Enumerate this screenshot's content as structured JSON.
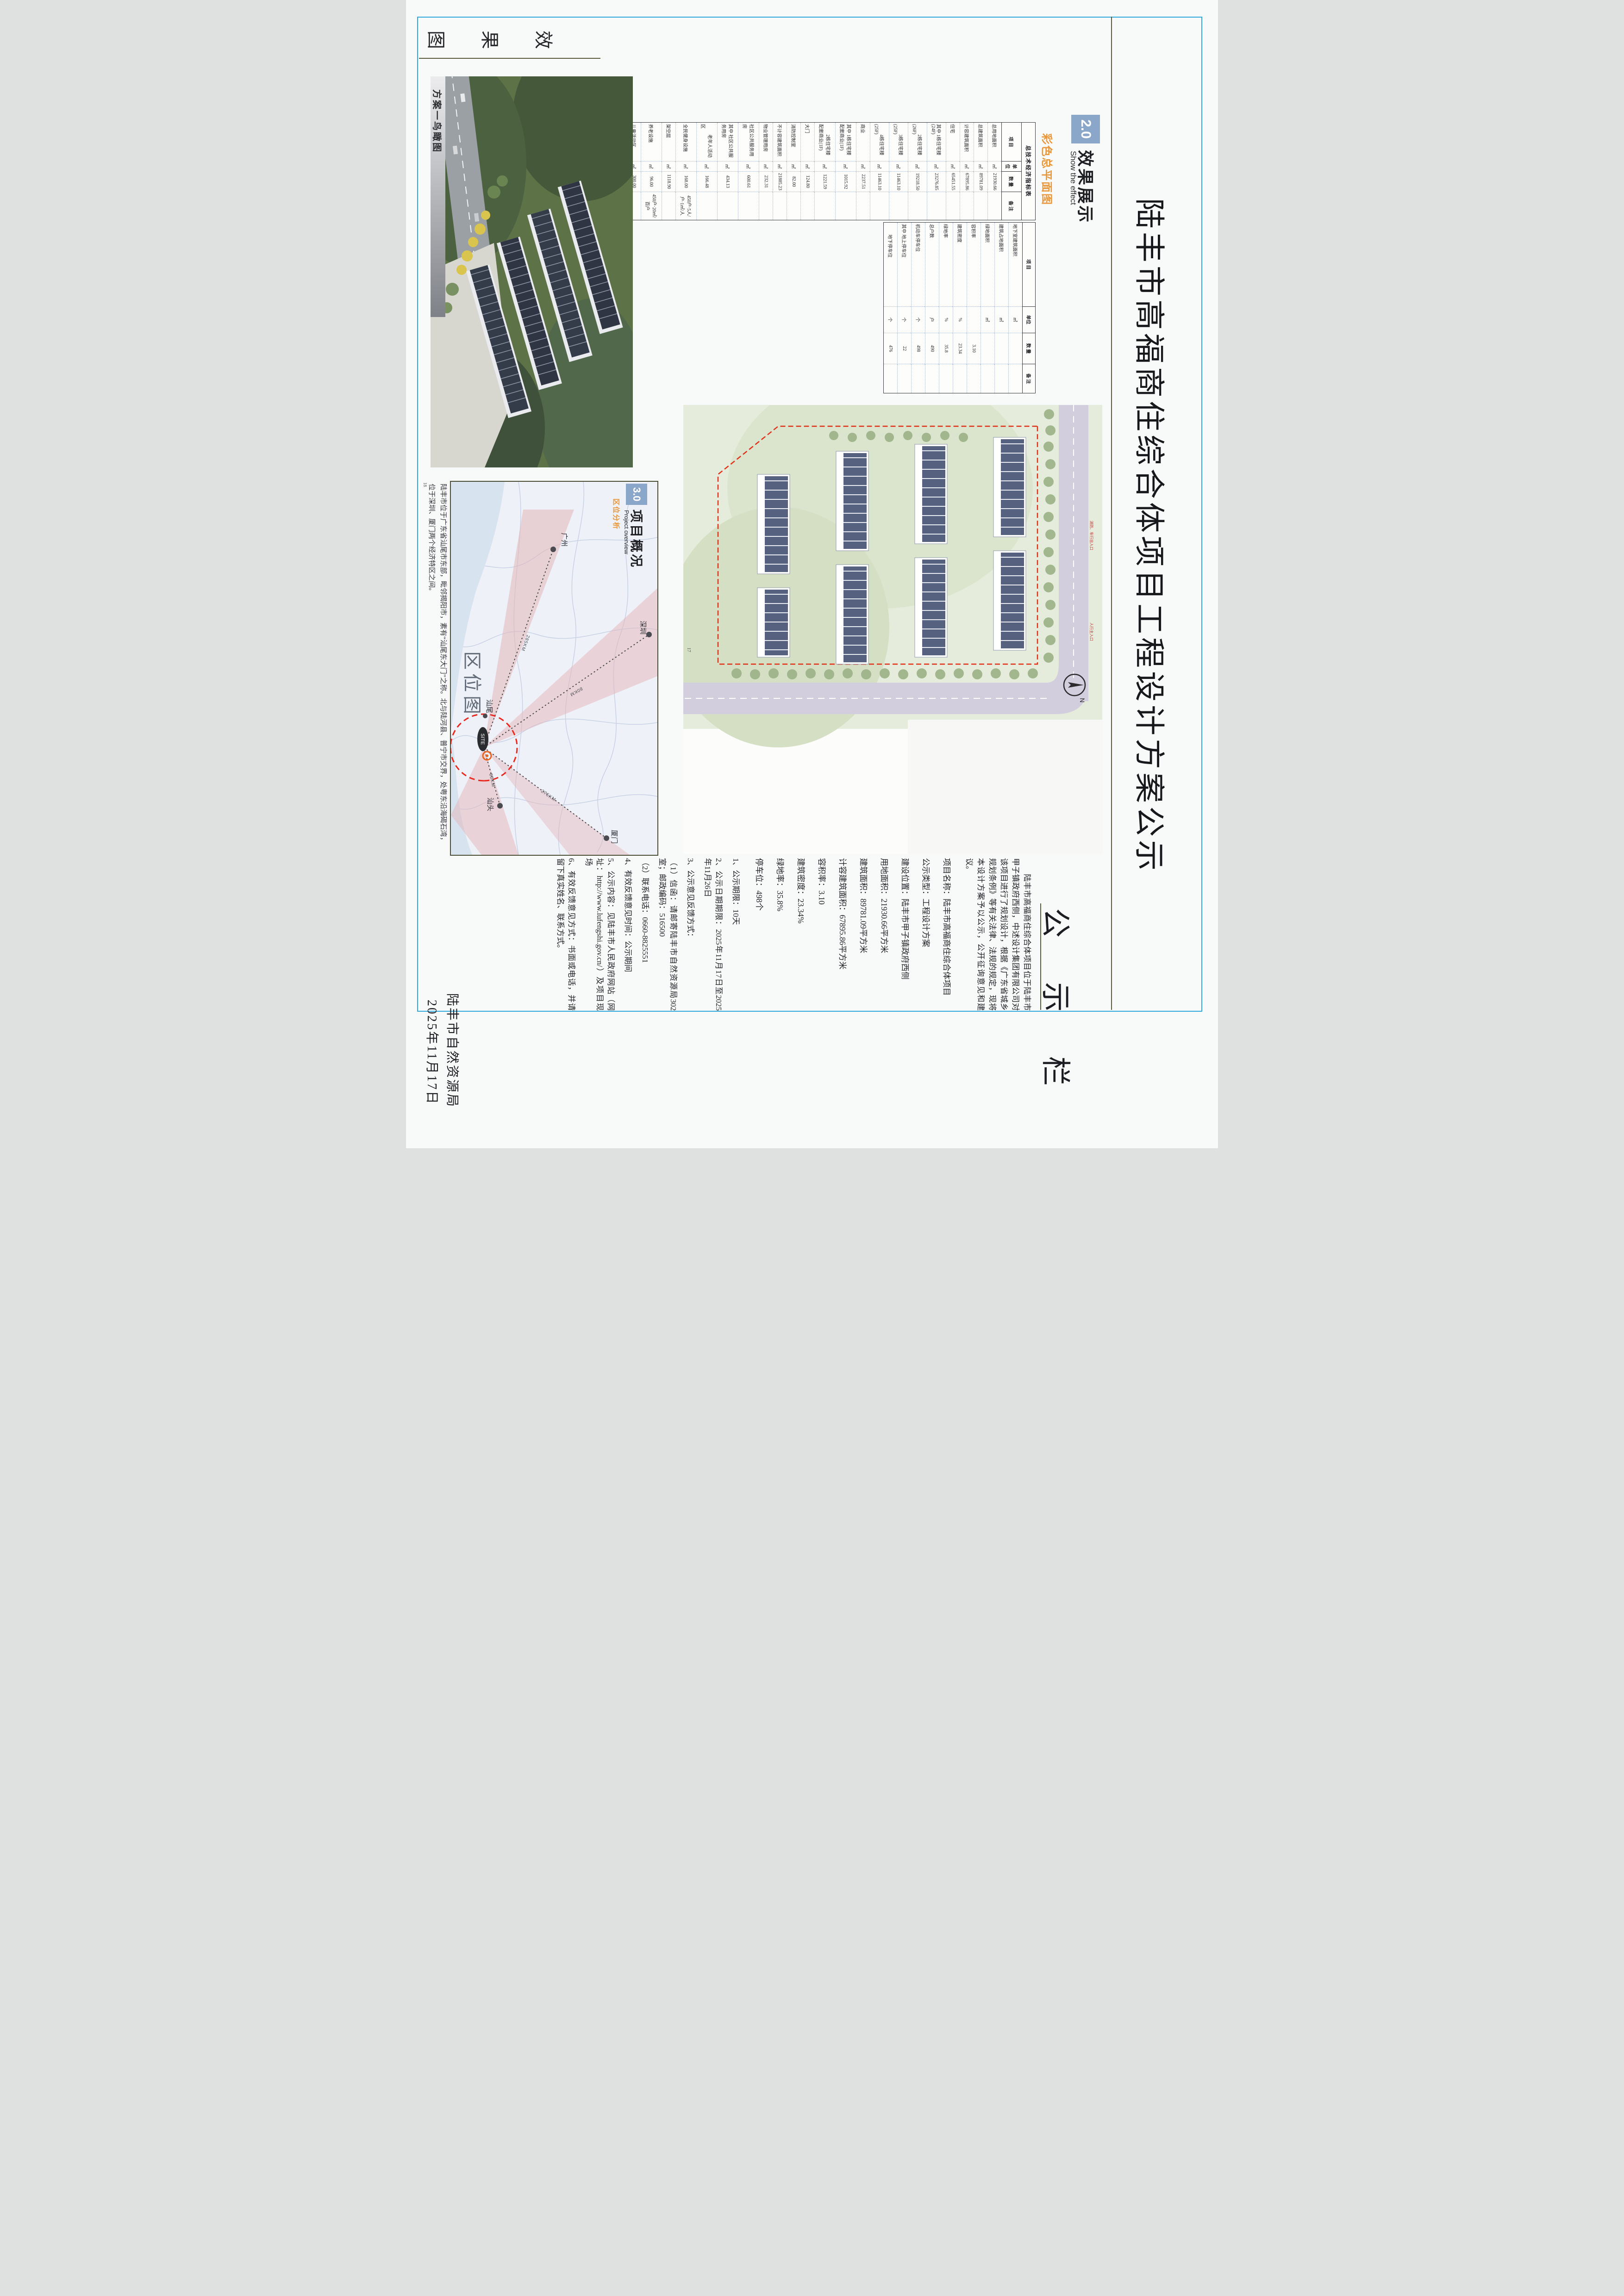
{
  "page": {
    "bg": "#f8fafa",
    "frame_color": "#2fa8dd",
    "accent_orange": "#e8973b",
    "accent_blue_box": "#8aa6c8"
  },
  "title": "陆丰市高福商住综合体项目工程设计方案公示",
  "board_header": "公 示 栏",
  "notice": {
    "intro": "陆丰市高福商住综合体项目位于陆丰市甲子镇政府西侧，中述设计集团有限公司对该项目进行了规划设计，根据《广东省城乡规划条例》等有关法律、法规的规定，现将本设计方案予以公示，公开征询意见和建议。",
    "info_lines": [
      "项目名称：陆丰市高福商住综合体项目",
      "公示类型：工程设计方案",
      "建设位置：陆丰市甲子镇政府西侧",
      "用地面积：21930.66平方米",
      "建筑面积：89781.09平方米",
      "计容建筑面积：67895.86平方米",
      "容积率：3.10",
      "建筑密度：23.34%",
      "绿地率：35.8%",
      "停车位：498个"
    ],
    "item_lines": [
      "1、公示期限：10天",
      "2、公示日期期限：2025年11月17日至2025年11月26日",
      "3、公示意见反馈方式：",
      "（1）信函：请邮寄陆丰市自然资源局302室；邮政编码：516500",
      "（2）联系电话：0660-8825551",
      "4、有效反馈意见时间：公示期间",
      "5、公示内容：见陆丰市人民政府网站（网址：http://www.lufengshi.gov.cn/）及项目现场",
      "6、有效反馈意见方式：书面或电话，并请留下真实姓名、联系方式。"
    ],
    "signature": "陆丰市自然资源局",
    "date": "2025年11月17日"
  },
  "section2": {
    "num": "2.0",
    "title": "效果展示",
    "subtitle": "Show the effect",
    "label": "彩色总平面图"
  },
  "section3": {
    "num": "3.0",
    "title": "项目概况",
    "subtitle": "Project overview",
    "label": "区位分析"
  },
  "tabs": {
    "left_tab_chars": [
      "效",
      "果",
      "图"
    ],
    "render_caption": "方案一鸟瞰图",
    "map_caption": "区位图"
  },
  "table_a": {
    "title": "总技术经济指标表",
    "headers": [
      "项 目",
      "单位",
      "数 量",
      "备 注"
    ],
    "rows": [
      [
        "总用地面积",
        "㎡",
        "21930.66",
        ""
      ],
      [
        "总建筑面积",
        "㎡",
        "89781.09",
        ""
      ],
      [
        "计容建筑面积",
        "㎡",
        "67895.86",
        ""
      ],
      [
        "住宅",
        "㎡",
        "65451.55",
        ""
      ],
      [
        "其中 1栋住宅楼(24F)",
        "㎡",
        "23276.85",
        ""
      ],
      [
        "　　 2栋住宅楼(26F)",
        "㎡",
        "19218.50",
        ""
      ],
      [
        "　　 3栋住宅楼(25F)",
        "㎡",
        "11463.10",
        ""
      ],
      [
        "　　 4栋住宅楼(25F)",
        "㎡",
        "11463.10",
        ""
      ],
      [
        "商业",
        "㎡",
        "2237.51",
        ""
      ],
      [
        "其中 1栋住宅楼配套商业(1F)",
        "㎡",
        "1015.92",
        ""
      ],
      [
        "　　 2栋住宅楼配套商业(1F)",
        "㎡",
        "1221.59",
        ""
      ],
      [
        "大门",
        "㎡",
        "124.80",
        ""
      ],
      [
        "消防控制室",
        "㎡",
        "82.00",
        ""
      ],
      [
        "不计容建筑面积",
        "㎡",
        "21885.23",
        ""
      ],
      [
        "物业管理用房",
        "㎡",
        "232.31",
        ""
      ],
      [
        "社区公共服务用房",
        "㎡",
        "600.61",
        ""
      ],
      [
        "其中 社区公共服务用房",
        "㎡",
        "434.13",
        ""
      ],
      [
        "　　 老年人活动区",
        "㎡",
        "166.48",
        ""
      ],
      [
        "全民健身设施",
        "㎡",
        "168.00",
        "450户·5人/户·1㎡/人"
      ],
      [
        "架空层",
        "㎡",
        "1118.90",
        ""
      ],
      [
        "养老设施",
        "㎡",
        "96.00",
        "450户·20㎡/百户"
      ],
      [
        "儿童活动区",
        "㎡",
        "300.00",
        ""
      ]
    ]
  },
  "table_b": {
    "headers": [
      "项 目",
      "单位",
      "数 量",
      "备 注"
    ],
    "rows": [
      [
        "地下室建筑面积",
        "㎡",
        "",
        ""
      ],
      [
        "建筑占地面积",
        "㎡",
        "",
        ""
      ],
      [
        "绿地面积",
        "㎡",
        "",
        ""
      ],
      [
        "容积率",
        "",
        "3.10",
        ""
      ],
      [
        "建筑密度",
        "%",
        "23.34",
        ""
      ],
      [
        "绿地率",
        "%",
        "35.8",
        ""
      ],
      [
        "总户数",
        "户",
        "490",
        ""
      ],
      [
        "机动车停车位",
        "个",
        "498",
        ""
      ],
      [
        "其中 地上停车位",
        "个",
        "22",
        ""
      ],
      [
        "　　 地下停车位",
        "个",
        "476",
        ""
      ]
    ]
  },
  "site_plan": {
    "page_no": "17",
    "compass": "N"
  },
  "render": {
    "page_no": "18"
  },
  "map": {
    "cities": {
      "guangzhou": "广州",
      "shenzhen": "深圳",
      "shanwei": "汕尾",
      "shantou": "汕头",
      "xiamen": "厦门"
    },
    "site_label": "SITE",
    "distances": {
      "d1": "285KM",
      "d2": "80KM",
      "d3": "80KM",
      "d4": "275KM"
    },
    "desc_lines": [
      "陆丰市位于广东省汕尾市东部，毗邻揭阳市，素有“汕尾东大门”之称。北与陆河县、普宁市交界，处粤东沿海碣石湾，",
      "位于深圳、厦门两个经济特区之间。"
    ]
  }
}
